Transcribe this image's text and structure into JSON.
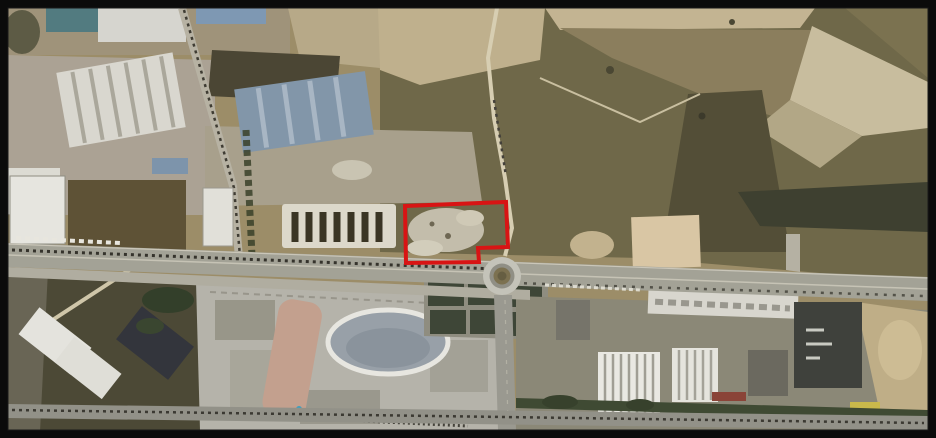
{
  "figure": {
    "title": "Aerial satellite view with highlighted plot",
    "type": "satellite-imagery",
    "description": "Satellite aerial photograph of an industrial and commercial area along an east-west main road with a roundabout; ploughed agricultural fields to the north-east, a large shopping-centre complex to the south, and a vacant dirt plot north-west of the roundabout outlined in red."
  },
  "annotation": {
    "label": "highlighted-plot",
    "shape": "polygon",
    "points": "405,206 506,202 508,247 478,248 479,262 406,263",
    "stroke_color": "#d81414",
    "stroke_width": "4"
  },
  "roundabout": {
    "cx": "502",
    "cy": "276",
    "outer_r": "19",
    "ring_r": "12.5",
    "inner_r": "8.5",
    "hub_r": "4.5"
  },
  "frame": {
    "color": "#0b0b0b",
    "thickness_px": 8
  },
  "palette": {
    "frame_black": "#0b0b0b",
    "annotation_red": "#d81414",
    "field_tan": "#9c8d68",
    "field_olive": "#6f6849",
    "field_pale": "#c8bd9e",
    "field_dark": "#534e37",
    "road_gray": "#a3a296",
    "concrete_gray": "#aba294",
    "building_white": "#e1e0d9",
    "building_blue": "#8296a9",
    "dark_field": "#4c4936",
    "trees_green": "#3a4129",
    "sand": "#c9b68c",
    "pool_blue": "#3fa8c8"
  },
  "features": [
    {
      "name": "industrial-zone-northwest",
      "description": "Industrial estate with white and blue-grey warehouse roofs"
    },
    {
      "name": "agricultural-fields-northeast",
      "description": "Ploughed tan and olive farmland with winding pale tracks"
    },
    {
      "name": "highlighted-plot",
      "description": "Vacant dirt plot outlined in red, north-west of the roundabout"
    },
    {
      "name": "row-of-sheds",
      "description": "Comb-shaped row of white sheds west of the highlighted plot"
    },
    {
      "name": "main-road",
      "description": "East-west dual carriageway crossing the full image with traffic"
    },
    {
      "name": "roundabout",
      "description": "Roundabout on the main road south of the highlighted plot"
    },
    {
      "name": "shopping-centre-complex",
      "description": "Large commercial complex with oval-roofed building and winding slide structure"
    },
    {
      "name": "parking-lots",
      "description": "Tree-lined parking rows north of the shopping centre"
    },
    {
      "name": "industrial-buildings-southeast",
      "description": "Warehouses with striped white roofs and a dark-roofed building"
    },
    {
      "name": "dark-field-southwest",
      "description": "Dark olive field crossed by a pale track with angled white warehouses"
    },
    {
      "name": "bottom-road",
      "description": "Second road with traffic running along the bottom edge"
    }
  ]
}
